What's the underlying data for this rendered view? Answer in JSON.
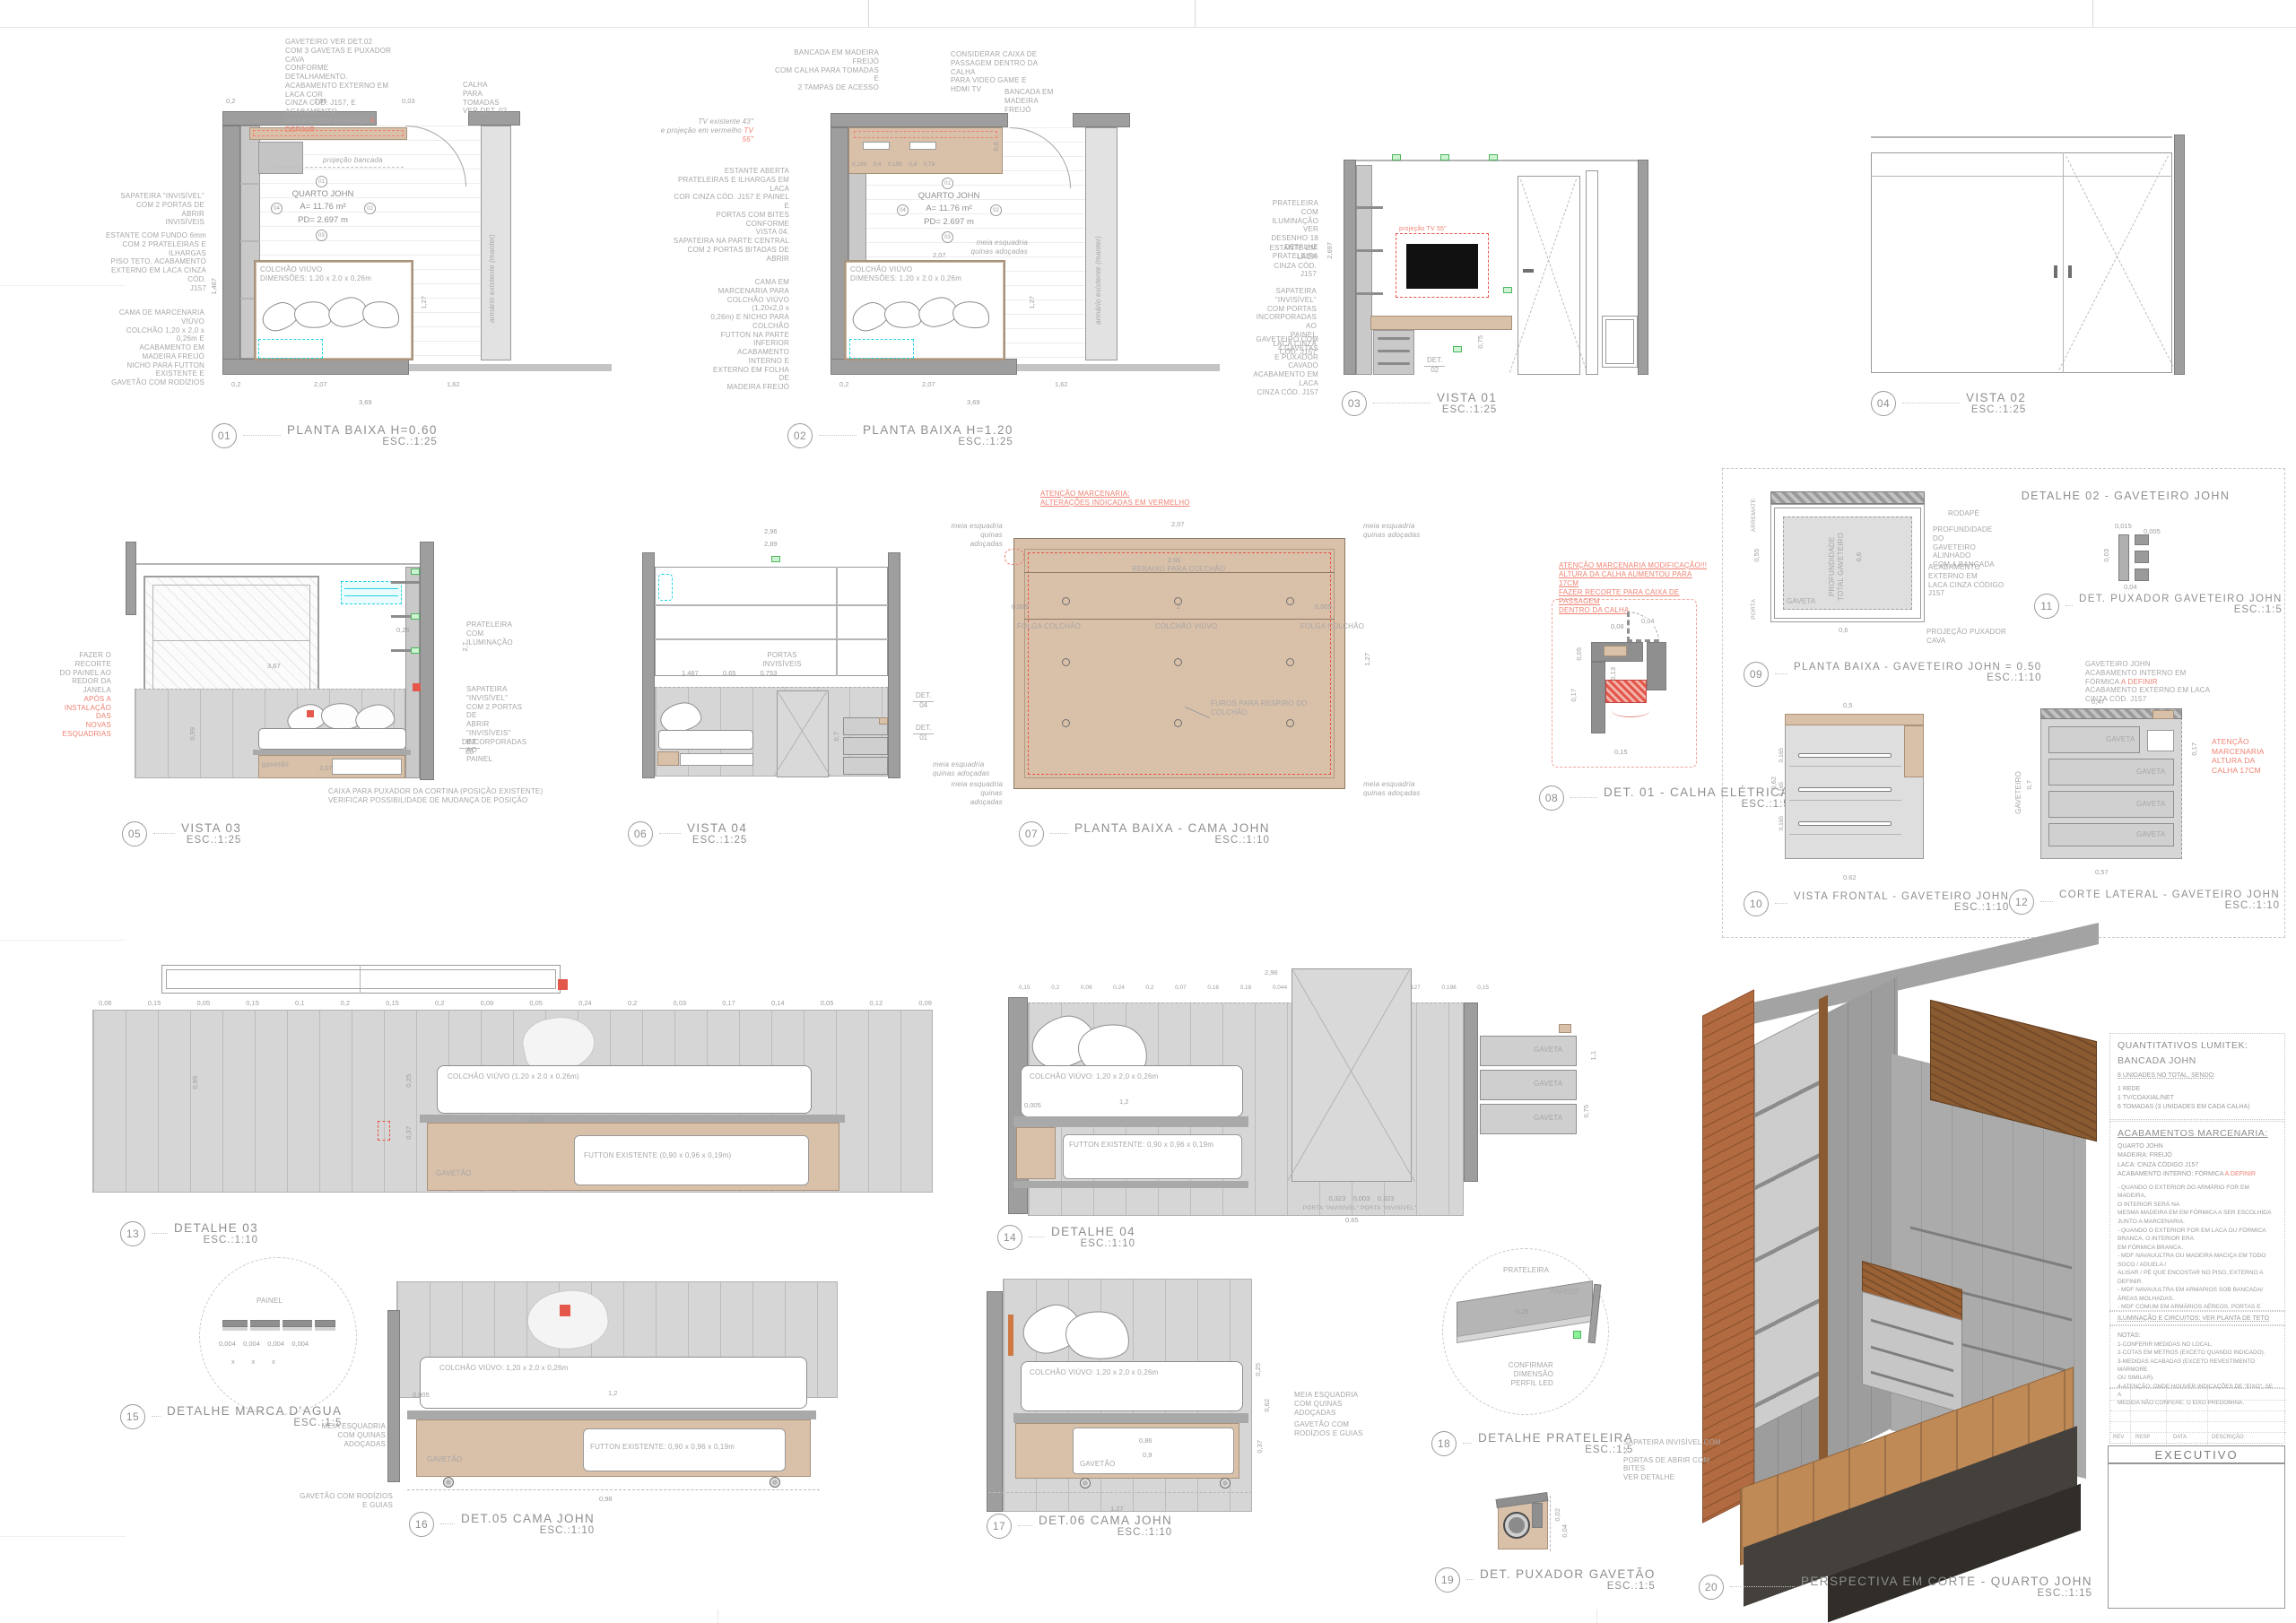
{
  "cap": [
    {
      "n": "01",
      "t": "PLANTA BAIXA H=0.60",
      "s": "ESC.:1:25"
    },
    {
      "n": "02",
      "t": "PLANTA BAIXA H=1.20",
      "s": "ESC.:1:25"
    },
    {
      "n": "03",
      "t": "VISTA 01",
      "s": "ESC.:1:25"
    },
    {
      "n": "04",
      "t": "VISTA 02",
      "s": "ESC.:1:25"
    },
    {
      "n": "05",
      "t": "VISTA 03",
      "s": "ESC.:1:25"
    },
    {
      "n": "06",
      "t": "VISTA 04",
      "s": "ESC.:1:25"
    },
    {
      "n": "07",
      "t": "PLANTA BAIXA - CAMA JOHN",
      "s": "ESC.:1:10"
    },
    {
      "n": "08",
      "t": "DET. 01 - CALHA ELÉTRICA",
      "s": "ESC.:1:5"
    },
    {
      "n": "09",
      "t": "PLANTA BAIXA - GAVETEIRO JOHN = 0.50",
      "s": "ESC.:1:10"
    },
    {
      "n": "10",
      "t": "VISTA FRONTAL - GAVETEIRO JOHN",
      "s": "ESC.:1:10"
    },
    {
      "n": "11",
      "t": "DET. PUXADOR GAVETEIRO JOHN",
      "s": "ESC.:1:5"
    },
    {
      "n": "12",
      "t": "CORTE LATERAL - GAVETEIRO JOHN",
      "s": "ESC.:1:10"
    },
    {
      "n": "13",
      "t": "DETALHE 03",
      "s": "ESC.:1:10"
    },
    {
      "n": "14",
      "t": "DETALHE 04",
      "s": "ESC.:1:10"
    },
    {
      "n": "15",
      "t": "DETALHE MARCA D'AGUA",
      "s": "ESC.:1:5"
    },
    {
      "n": "16",
      "t": "DET.05  CAMA JOHN",
      "s": "ESC.:1:10"
    },
    {
      "n": "17",
      "t": "DET.06  CAMA JOHN",
      "s": "ESC.:1:10"
    },
    {
      "n": "18",
      "t": "DETALHE PRATELEIRA",
      "s": "ESC.:1:5"
    },
    {
      "n": "19",
      "t": "DET. PUXADOR GAVETÃO",
      "s": "ESC.:1:5"
    },
    {
      "n": "20",
      "t": "PERSPECTIVA EM CORTE - QUARTO JOHN",
      "s": "ESC.:1:15"
    }
  ],
  "box_title": "DETALHE 02 - GAVETEIRO JOHN",
  "lbl": {
    "gaveta": "GAVETA",
    "gavetao": "GAVETÃO",
    "gavetao_s": "gavetão",
    "det": "DET.",
    "n01": "01",
    "n02": "02",
    "n03": "03",
    "n04": "04",
    "quarto": "QUARTO JOHN",
    "area": "A= 11.76 m²",
    "pd": "PD= 2.697 m",
    "colchao_plan": "COLCHÃO VIÚVO\nDIMENSÕES: 1.20 x 2.0 x 0,26m",
    "armario": "armário existente (manter)",
    "meia": "meia esquadria\nquinas adoçadas",
    "proj_bancada": "projeção bancada",
    "portas_inv": "PORTAS\nINVISÍVEIS"
  },
  "d01": {
    "gav": "GAVETEIRO VER DET.02\nCOM 3 GAVETAS E PUXADOR CAVA\nCONFORME DETALHAMENTO.\nACABAMENTO EXTERNO EM LACA COR\nCINZA CÓD. J157, E ACABAMENTO\nINTERNO EM FÓRMICA ",
    "gav_red": "A DEFINIR",
    "calha": "CALHA\nPARA TOMADAS\nVER DET. 02",
    "sapateira": "SAPATEIRA \"INVISÍVEL\"\nCOM 2 PORTAS DE ABRIR\nINVISÍVEIS",
    "estante": "ESTANTE COM FUNDO 6mm\nCOM 2 PRATELEIRAS E ILHARGAS\nPISO TETO, ACABAMENTO\nEXTERNO EM LACA CINZA CÓD.\nJ157",
    "cama": "CAMA DE MARCENARIA VIÚVO\nCOLCHÃO 1,20 x 2,0 x 0,26m E\nACABAMENTO EM MADEIRA FREIJÓ\nNICHO PARA FUTTON EXISTENTE E\nGAVETÃO COM RODÍZIOS",
    "dt1": "0,2",
    "dt2": "1,95",
    "dt3": "0,03",
    "db1": "0,2",
    "db2": "2,07",
    "db3": "1,62",
    "db4": "3,69",
    "dr": "1,27",
    "dl": "1,467"
  },
  "d02": {
    "bancada": "BANCADA EM MADEIRA FREIJÓ\nCOM CALHA PARA TOMADAS E\n2 TAMPAS DE ACESSO",
    "caixa": "CONSIDERAR CAIXA DE\nPASSAGEM DENTRO DA CALHA\nPARA VIDEO GAME E HDMI TV",
    "tv": "TV existente 43\"\ne projeção em vermelho ",
    "tv_red": "TV 55\"",
    "estante": "ESTANTE ABERTA\nPRATELEIRAS E ILHARGAS EM LACA\nCOR CINZA CÓD. J157 E PAINEL E\nPORTAS COM BITES CONFORME\nVISTA 04.\nSAPATEIRA NA PARTE CENTRAL\nCOM 2 PORTAS BITADAS DE ABRIR",
    "cama": "CAMA EM MARCENARIA PARA\nCOLCHÃO VIÚVO (1,20x2,0 x\n0,26m) E NICHO PARA COLCHÃO\nFUTTON NA PARTE INFERIOR\nACABAMENTO INTERNO E\nEXTERNO EM FOLHA DE\nMADEIRA FREIJÓ",
    "bancada_lbl": "BANCADA EM MADEIRA\nFREIJÓ",
    "dims_calha": "0,195    0,4    0,195    0,4    0,79",
    "d06": "0,6",
    "d207": "2,07",
    "db1": "0,2",
    "db2": "2,07",
    "db3": "1,62",
    "db4": "3,69",
    "dr": "1,27"
  },
  "d03": {
    "prat": "PRATELEIRA COM\nILUMINAÇÃO VER\nDESENHO 18 DETALHE\nPRATELEIRA",
    "estante": "ESTANTE EM LACA\nCINZA CÓD. J157",
    "sap": "SAPATEIRA \"INVISÍVEL\"\nCOM PORTAS\nINCORPORADAS AO\nPAINEL\nLACA CINZA CÓD. J157",
    "gav": "GAVETEIRO COM 4 GAVETAS\nE PUXADOR CAVADO\nACABAMENTO EM LACA\nCINZA CÓD. J157",
    "tv": "projeção TV 55\"",
    "pd": "2,697",
    "d075": "0,75"
  },
  "d05": {
    "rec": "FAZER O RECORTE\nDO PAINEL AO\nREDOR DA JANELA\n",
    "rec_red": "APÓS A\nINSTALAÇÃO DAS\nNOVAS\nESQUADRIAS",
    "prat": "PRATELEIRA COM\nILUMINAÇÃO",
    "sap": "SAPATEIRA \"INVISÍVEL\"\nCOM 2 PORTAS DE\nABRIR \"INVISÍVEIS\"\nINCORPORADAS AO\nPAINEL",
    "caixa": "CAIXA PARA PUXADOR DA CORTINA (POSIÇÃO EXISTENTE)\nVERIFICAR POSSIBILIDADE DE MUDANÇA DE POSIÇÃO",
    "d367": "3,67",
    "d207": "2,07",
    "d099": "0,99",
    "d27": "2,7",
    "d025": "0,25"
  },
  "d06": {
    "d296": "2,96",
    "d289": "2,89",
    "dims": "1,487             0,65             0,753",
    "d07": "0,7"
  },
  "d07": {
    "red": "ATENÇÃO MARCENARIA:\nALTERAÇÕES INDICADAS EM VERMELHO",
    "rebaixo": "REBAIXO PARA COLCHÃO",
    "colchao": "COLCHÃO VIÚVO",
    "folga": "FOLGA COLCHÃO",
    "furos": "FUROS PARA RESPIRO DO COLCHÃO",
    "d207": "2,07",
    "d201": "2.01",
    "d2": "2",
    "d127": "1,27",
    "d0005": "0,005"
  },
  "d08": {
    "red": "ATENÇÃO MARCENARIA MODIFICAÇÃO!!!\nALTURA DA CALHA AUMENTOU PARA 17CM\nFAZER RECORTE PARA CAIXA DE PASSAGEM\nDENTRO DA CALHA",
    "d015": "0,15",
    "d017": "0,17",
    "d013": "0,13",
    "d005": "0,05",
    "d008": "0,08",
    "d004": "0,04"
  },
  "d09": {
    "prof": "PROFUNDIDADE\nTOTAL GAVETEIRO",
    "d06": "0,6",
    "arremate": "ARREMATE",
    "porta": "PORTA",
    "d055": "0,55",
    "d015": "0,15",
    "rodape": "RODAPÉ",
    "prof_note": "PROFUNDIDADE DO\nGAVETEIRO ALINHADO\nCOM A BANCADA",
    "acab": "ACABAMENTO EXTERNO EM\nLACA CINZA CÓDIGO J157",
    "proj": "PROJEÇÃO PUXADOR CAVA"
  },
  "d10": {
    "d062": "0,62",
    "d05": "0,5",
    "d0165": "0,165"
  },
  "d11": {
    "d0015": "0,015",
    "d0005": "0,005",
    "d003": "0,03",
    "d004": "0,04"
  },
  "d12": {
    "note": "GAVETEIRO JOHN\nACABAMENTO INTERNO EM FÓRMICA ",
    "note_red": "A DEFINIR",
    "note2": "\nACABAMENTO EXTERNO EM LACA CINZA CÓD. J157",
    "red": "ATENÇÃO\nMARCENARIA\nALTURA DA\nCALHA 17CM",
    "gaveteiro": "GAVETEIRO",
    "d07": "0,7",
    "d047": "0,47",
    "d057": "0,57",
    "d017": "0,17"
  },
  "d13": {
    "colchao": "COLCHÃO VIÚVO (1.20 x 2.0 x 0.26m)",
    "futton": "FUTTON EXISTENTE (0,90 x 0,96 x 0,19m)",
    "pdims": "0,06  0,15  0,05  0,15  0,1  0,2  0,15  0,2  0,09  0,05  0,24  0,2  0,03  0,17  0,14  0,05  0,12  0,09",
    "d099": "0,99",
    "d104": "1,04",
    "d025": "0,25",
    "d037": "0,37"
  },
  "d14": {
    "colchao": "COLCHÃO VIÚVO: 1,20 x 2,0 x 0,26m",
    "futton": "FUTTON EXISTENTE: 0,90 x 0,96 x 0,19m",
    "d296": "2,96",
    "pdims": "0,15  0,2  0,09  0,24  0,2  0,07  0,16  0,18  0,044  0,075  0,2  0,09  0,127  0,198  0,15",
    "d12": "1,2",
    "d0005": "0,005",
    "dimrow": "0,323    0,003    0,323",
    "portas": "PORTA \"INVISÍVEL\"        PORTA \"INVISÍVEL\"",
    "d065": "0,65",
    "d11": "1,1",
    "d075": "0,75"
  },
  "d15": {
    "painel": "PAINEL",
    "dims": "0,004    0,004    0,004    0,004",
    "xs": "x         x         x"
  },
  "d16": {
    "colchao": "COLCHÃO VIÚVO: 1,20 x 2,0 x 0,26m",
    "futton": "FUTTON EXISTENTE: 0,90 x 0,96 x 0,19m",
    "meia": "MEIA ESQUADRIA\nCOM QUINAS ADOÇADAS",
    "guias": "GAVETÃO COM RODÍZIOS E GUIAS",
    "d12": "1,2",
    "d0005": "0,005",
    "d098": "0,98"
  },
  "d17": {
    "colchao": "COLCHÃO VIÚVO: 1,20 x 2,0 x 0,26m",
    "meia": "MEIA ESQUADRIA\nCOM QUINAS ADOÇADAS",
    "guias": "GAVETÃO COM\nRODÍZIOS E GUIAS",
    "d086": "0,86",
    "d09": "0,9",
    "d127": "1,27",
    "d062": "0,62",
    "d037": "0,37",
    "d025": "0,25"
  },
  "d18": {
    "prat": "PRATELEIRA",
    "parede": "PAREDE",
    "d025": "0,25",
    "confirm": "CONFIRMAR DIMENSÃO\nPERFIL LED"
  },
  "d19": {
    "d002": "0,02",
    "d004": "0,04"
  },
  "d20": {
    "sap": "SAPATEIRA INVISÍVEL COM 2\nPORTAS DE ABRIR COM BITES\nVER DETALHE"
  },
  "panel": {
    "q_title": "QUANTITATIVOS LUMITEK:",
    "q_sub": "BANCADA JOHN",
    "q_line": "8 UNIDADES NO TOTAL, SENDO:",
    "q_items": "1 REDE\n1 TV/COAXIAL/NET\n6 TOMADAS (3 UNIDADES EM CADA CALHA)",
    "a_title": "ACABAMENTOS MARCENARIA:",
    "a_sub": "QUARTO JOHN",
    "a_lines": "MADEIRA: FREIJÓ\nLACA: CINZA CÓDIGO J157\nACABAMENTO INTERNO: FÓRMICA ",
    "a_red": "A DEFINIR",
    "a_body": "- QUANDO O EXTERIOR DO ARMÁRIO FOR EM MADEIRA,\nO INTERIOR SERÁ NA\nMESMA MADEIRA EM EM FÓRMICA A SER ESCOLHIDA\nJUNTO A MARCENARIA.\n- QUANDO O EXTERIOR FOR EM LACA OU FÓRMICA\nBRANCA, O INTERIOR ERA\nEM FÓRMICA BRANCA.\n- MDF NAVAUULTRA OU MADEIRA MACIÇA EM TODO\nSOCO / ADUELA /\nALISAR / PÉ QUE ENCOSTAR NO PISO, EXTERNO A\nDEFINIR.\n- MDF NAVAUULTRA EM ARMARIOS SOB BANCADA/\nÁREAS MOLHADAS.\n- MDF COMUM EM ARMÁRIOS AÉREOS, PORTAS E\nPAINÉIS DE ÁREAS SECAS.",
    "ilum": "ILUMINAÇÃO E CIRCUITOS: VER PLANTA DE TETO",
    "n_title": "NOTAS:",
    "notas": "1-CONFERIR MEDIDAS NO LOCAL.\n2-COTAS EM METROS (EXCETO QUANDO INDICADO).\n3-MEDIDAS ACABADAS (EXCETO REVESTIMENTO MÁRMORE\nOU SIMILAR).\n4-ATENÇÃO: ONDE HOUVER INDICAÇÕES DE \"EIXO\", SE A\nMEDIDA NÃO CONFERE, O EIXO PREDOMINA.",
    "rev": "REV",
    "resp": "RESP",
    "data": "DATA",
    "desc": "DESCRIÇÃO",
    "exec": "EXECUTIVO"
  },
  "colors": {
    "accent_red": "#e4574b",
    "cyan": "#22d3e6",
    "green": "#49b85a",
    "tan": "#d9c0a9",
    "wood": "#8a5a31",
    "brick": "#b26b41"
  }
}
